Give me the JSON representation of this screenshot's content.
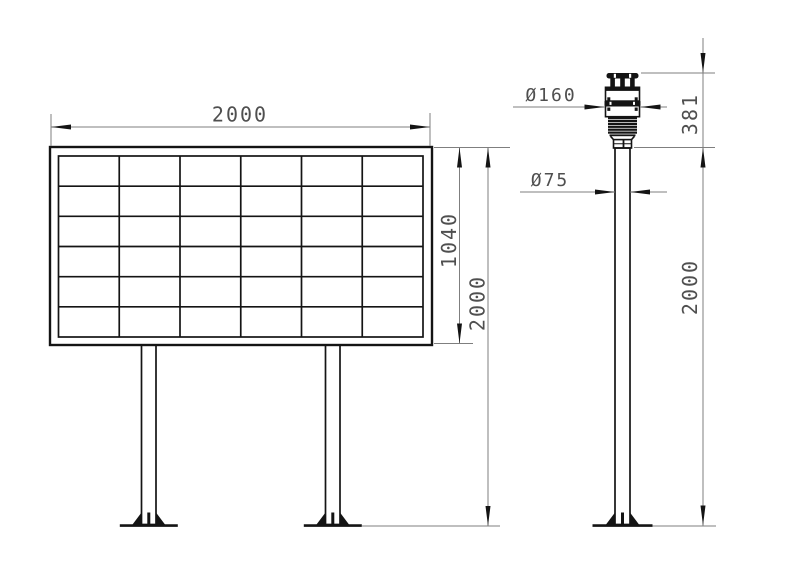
{
  "drawing": {
    "background_color": "#ffffff",
    "object_line_color": "#141414",
    "dimension_line_color": "#7f7f7f",
    "dimension_text_color": "#4f4f4f"
  },
  "board_view": {
    "dimensions": {
      "width": "2000",
      "panel_height": "1040",
      "overall_height": "2000"
    },
    "panel_grid": {
      "columns": 6,
      "rows": 6
    }
  },
  "station_view": {
    "dimensions": {
      "sensor_diameter": "Ø160",
      "pole_diameter": "Ø75",
      "sensor_height": "381",
      "pole_height": "2000"
    }
  }
}
